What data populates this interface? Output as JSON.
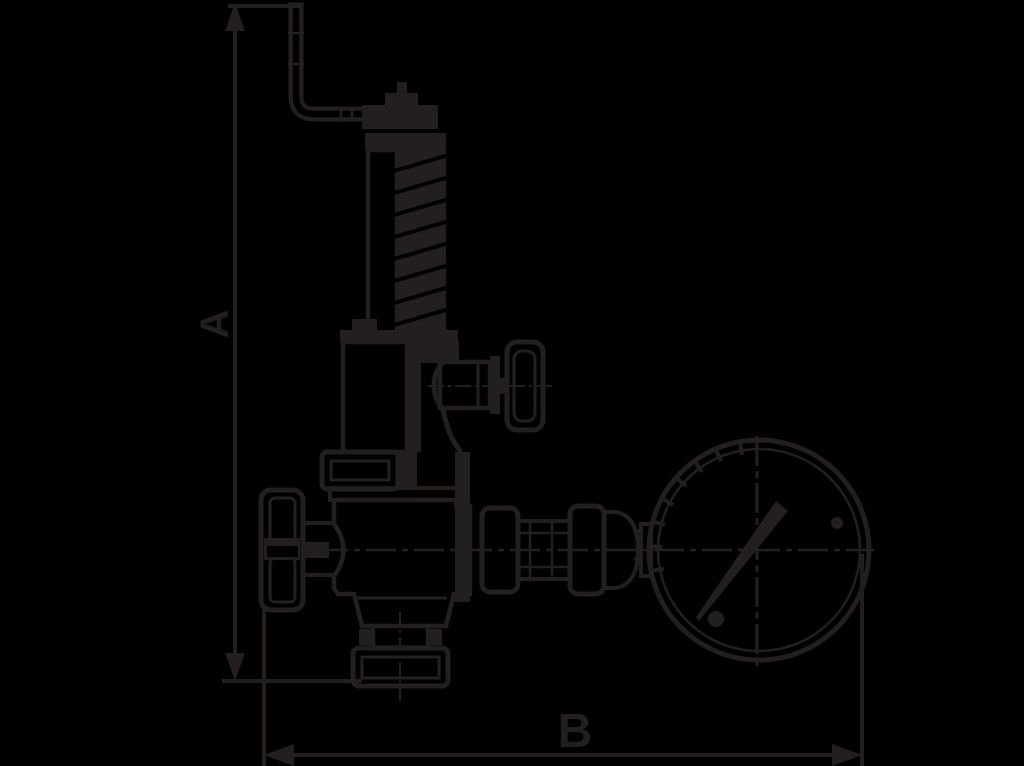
{
  "canvas": {
    "background_color": "#000000",
    "line_color": "#231f20"
  },
  "diagram": {
    "kind": "technical dimension drawing",
    "subject": "spring-loaded safety relief valve with lift lever, handwheel and pressure gauge",
    "dimension_labels": {
      "vertical": "A",
      "horizontal": "B"
    }
  }
}
